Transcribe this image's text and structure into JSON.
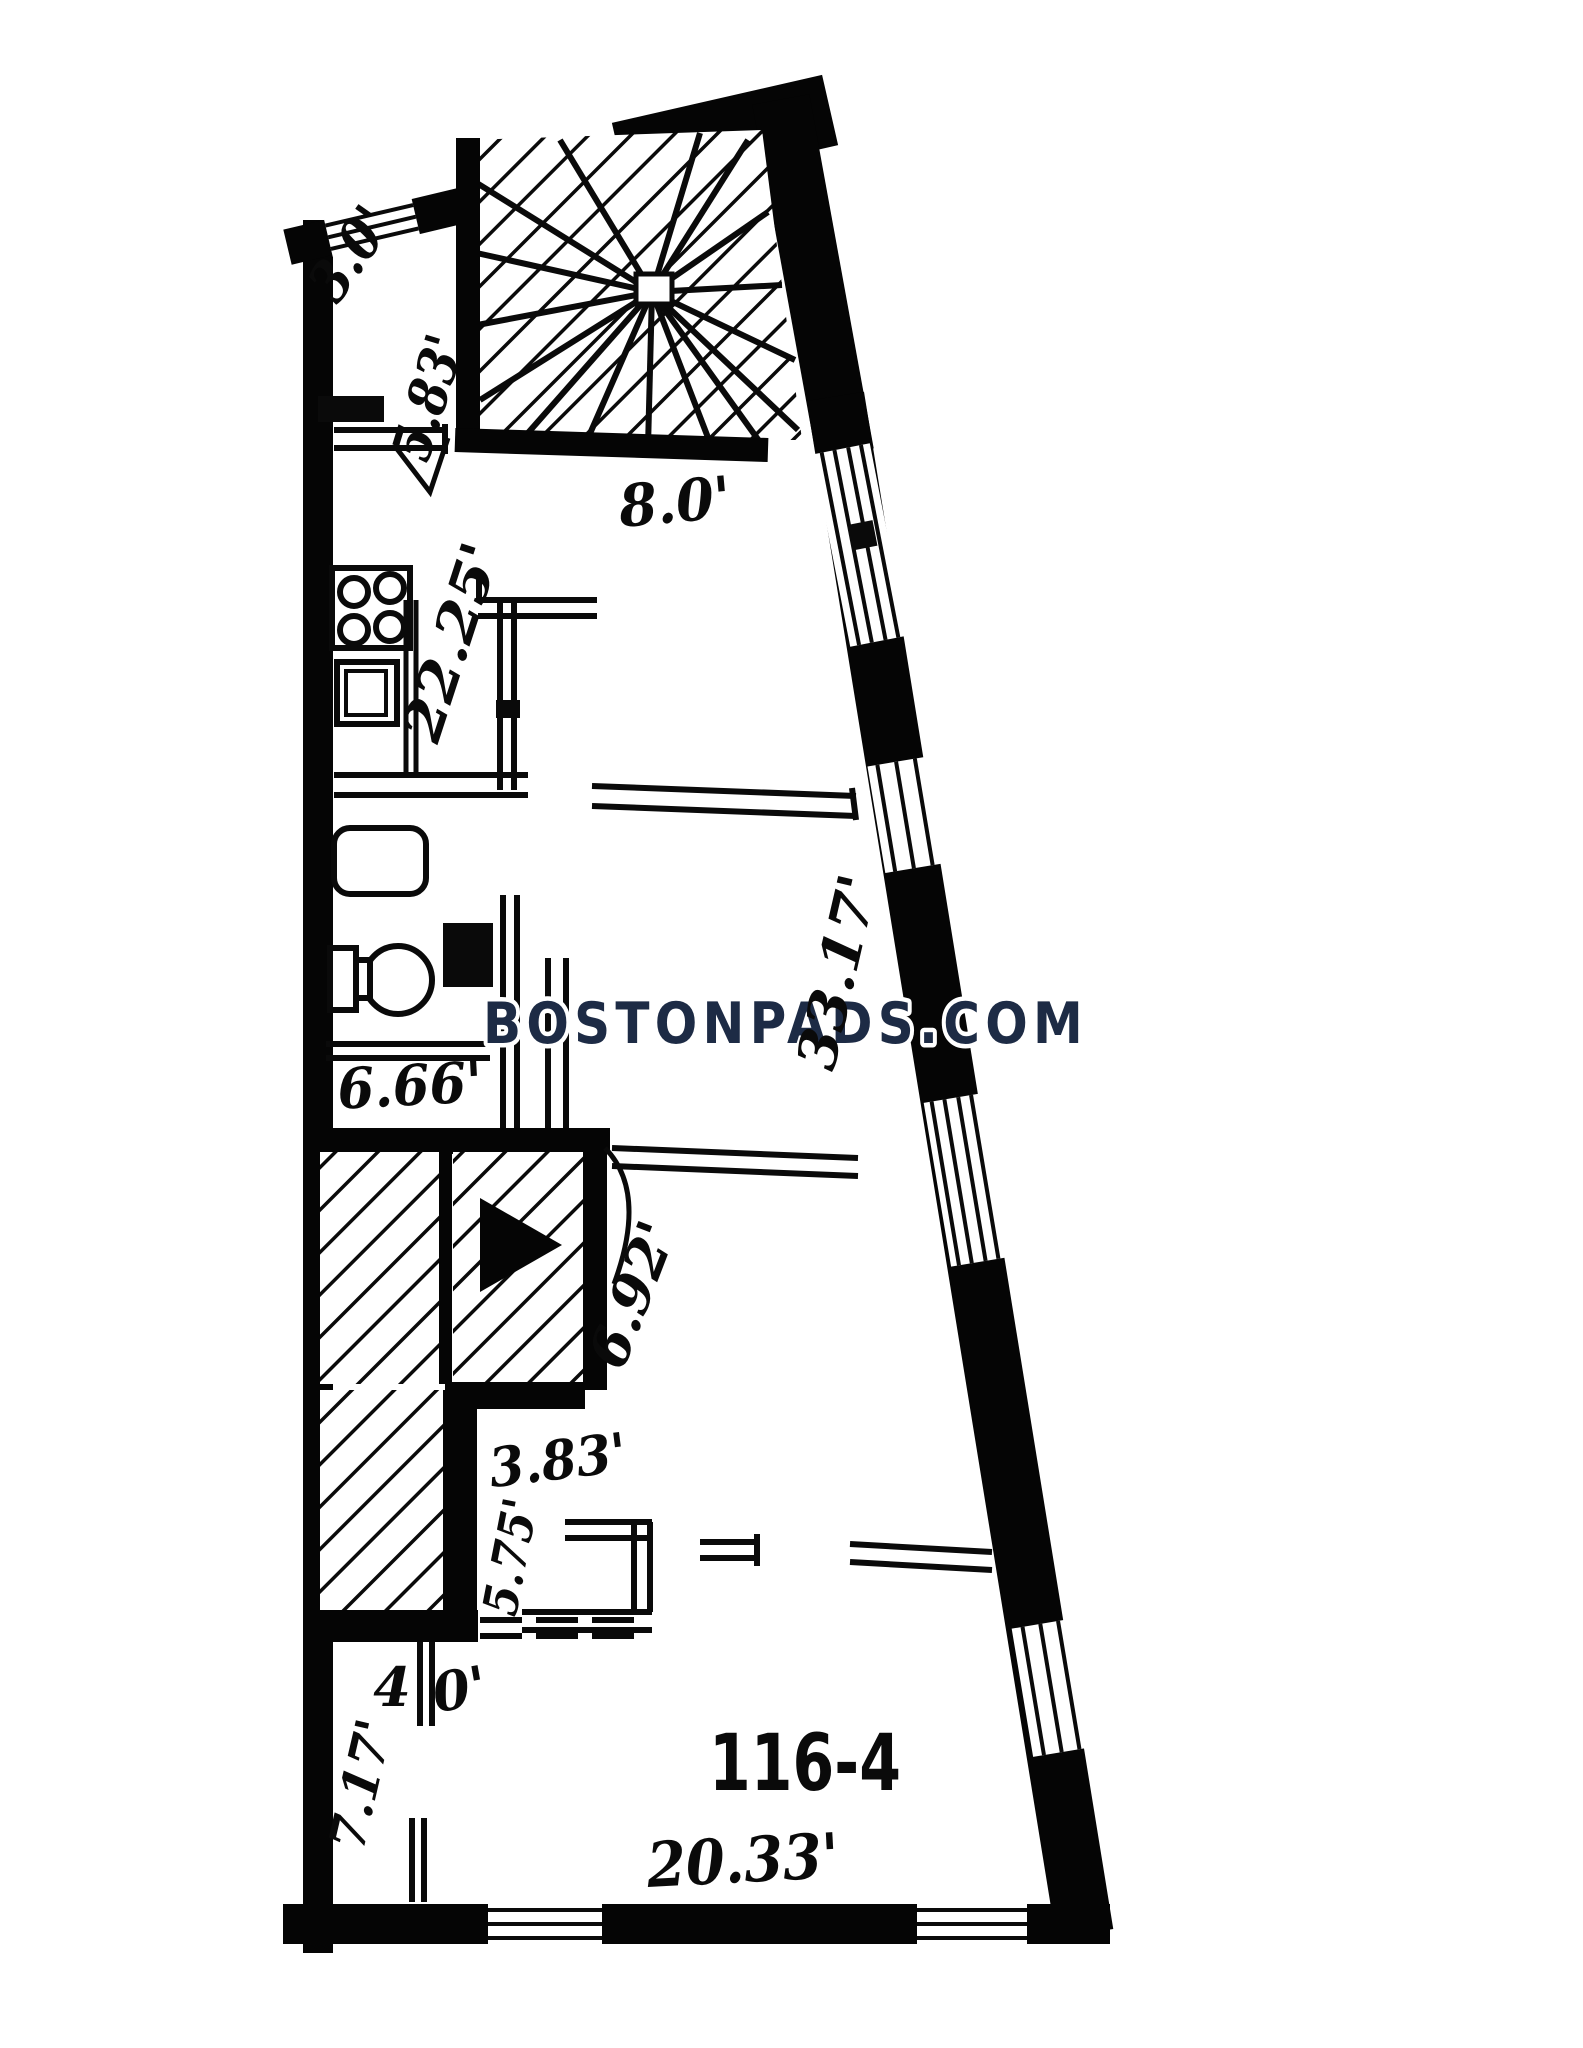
{
  "watermark": {
    "text": "BOSTONPADS.COM",
    "color": "#1d2b45"
  },
  "unit": {
    "number": "116-4"
  },
  "dimensions": {
    "top_width": "3.0'",
    "entry_depth": "5.83'",
    "stair_top_width": "8.0'",
    "west_wall": "22.25'",
    "bath_width": "6.66'",
    "east_wall": "33.17'",
    "stair_depth": "6.92'",
    "hall_width": "3.83'",
    "hall_depth": "5.75'",
    "door_left": "4",
    "door_right": "0'",
    "bedroom_depth": "7.17'",
    "south_wall": "20.33'"
  }
}
